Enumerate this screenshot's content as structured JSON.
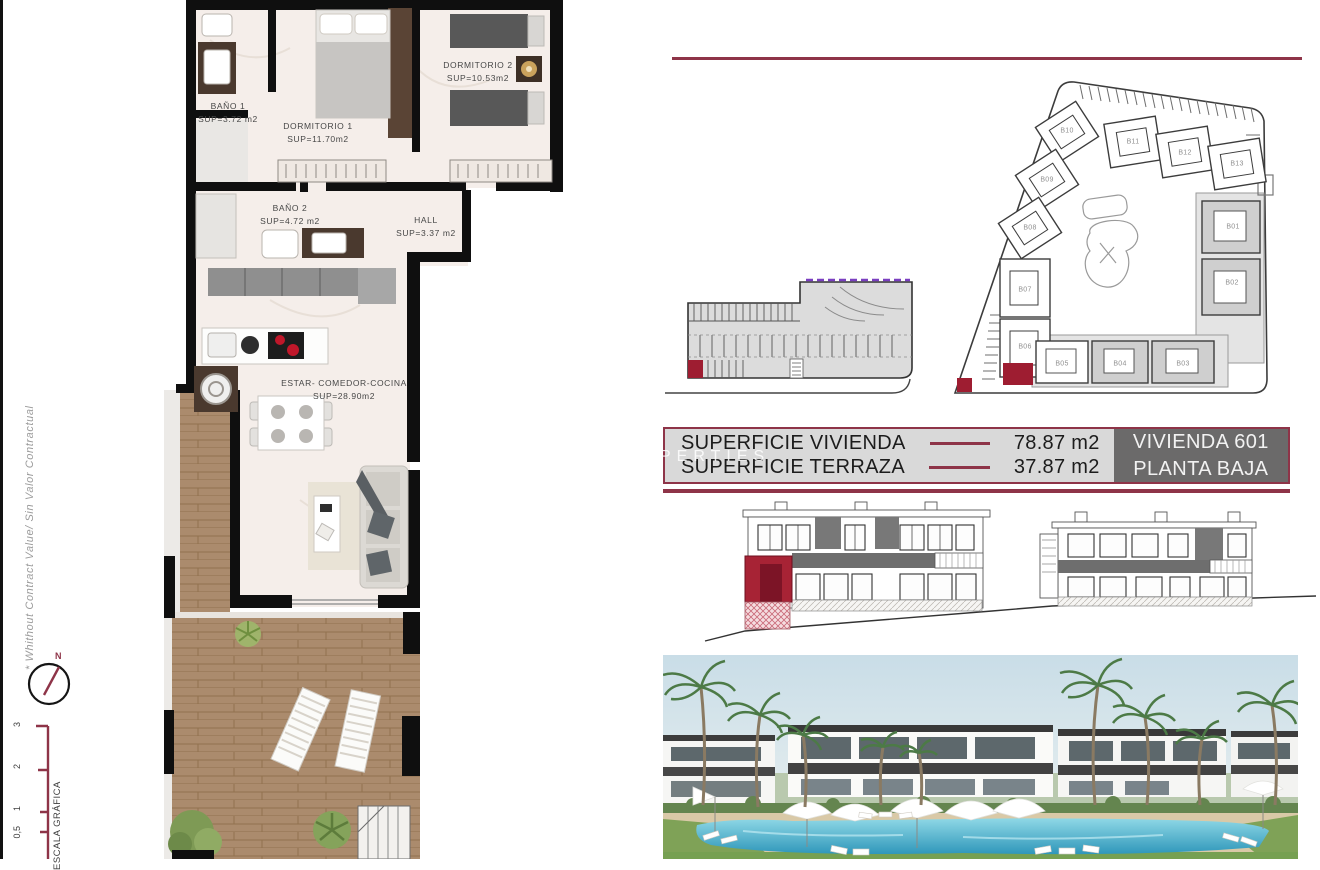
{
  "side": {
    "disclaimer": "* Whithout Contract Value/ Sin Valor Contractual",
    "compass_north": "N",
    "scale_caption": "ESCALA GRÁFICA",
    "scale_ticks": [
      "3",
      "2",
      "1",
      "0,5"
    ]
  },
  "floor_plan": {
    "rooms": [
      {
        "name": "BAÑO 1",
        "area": "SUP=3.72 m2"
      },
      {
        "name": "DORMITORIO 1",
        "area": "SUP=11.70m2"
      },
      {
        "name": "DORMITORIO 2",
        "area": "SUP=10.53m2"
      },
      {
        "name": "BAÑO 2",
        "area": "SUP=4.72  m2"
      },
      {
        "name": "HALL",
        "area": "SUP=3.37  m2"
      },
      {
        "name": "ESTAR-  COMEDOR-COCINA",
        "area": "SUP=28.90m2"
      }
    ]
  },
  "site_plan": {
    "buildings": [
      "B01",
      "B02",
      "B03",
      "B04",
      "B05",
      "B06",
      "B07",
      "B08",
      "B09",
      "B10",
      "B11",
      "B12",
      "B13"
    ]
  },
  "info_bar": {
    "rows": [
      {
        "label": "SUPERFICIE VIVIENDA",
        "value": "78.87 m2"
      },
      {
        "label": "SUPERFICIE TERRAZA",
        "value": "37.87 m2"
      }
    ],
    "unit_name": "VIVIENDA 601",
    "unit_floor": "PLANTA BAJA",
    "watermark": "PERTIES"
  },
  "colors": {
    "accent_maroon": "#8e3448",
    "highlight_red": "#a02236",
    "ramp_purple": "#7a3fc0",
    "deck_wood": "#ab8b6d"
  }
}
